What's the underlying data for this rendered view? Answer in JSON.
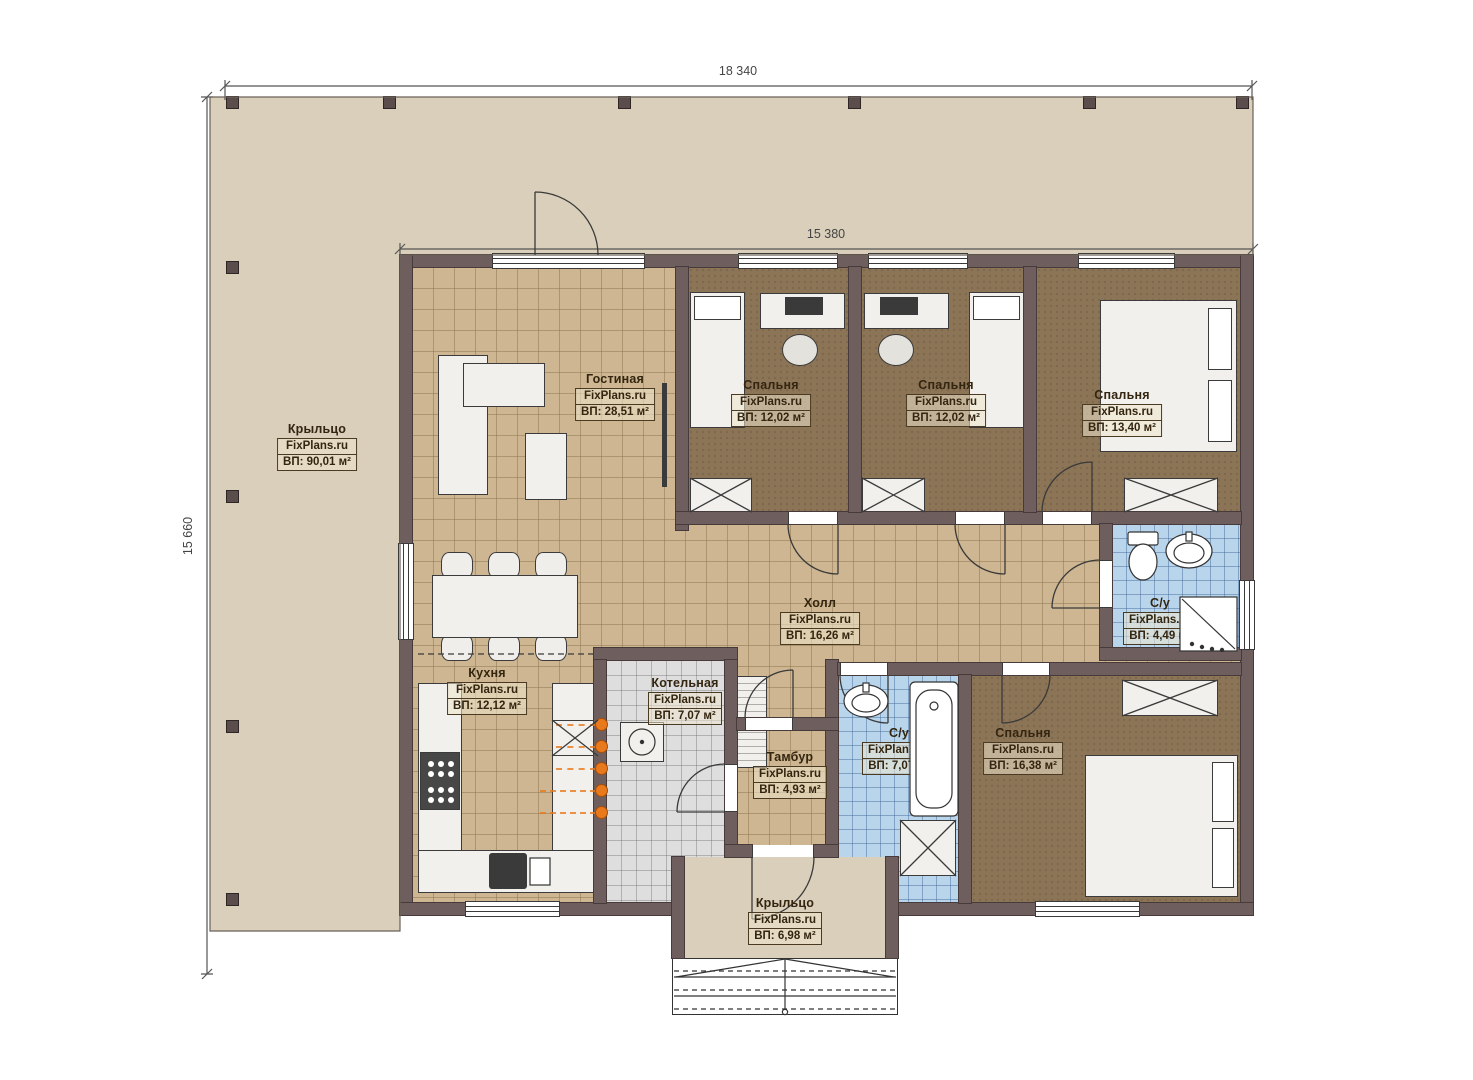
{
  "watermark": "FixPlans.ru",
  "dimensions": {
    "overall_width": "18 340",
    "house_width": "15 380",
    "overall_height": "15 660"
  },
  "rooms": [
    {
      "key": "porch-left",
      "name": "Крыльцо",
      "area": "ВП: 90,01 м²"
    },
    {
      "key": "living-room",
      "name": "Гостиная",
      "area": "ВП: 28,51 м²"
    },
    {
      "key": "bedroom-1",
      "name": "Спальня",
      "area": "ВП: 12,02 м²"
    },
    {
      "key": "bedroom-2",
      "name": "Спальня",
      "area": "ВП: 12,02 м²"
    },
    {
      "key": "bedroom-3",
      "name": "Спальня",
      "area": "ВП: 13,40 м²"
    },
    {
      "key": "hall",
      "name": "Холл",
      "area": "ВП: 16,26 м²"
    },
    {
      "key": "bathroom-top",
      "name": "С/у",
      "area": "ВП: 4,49 м²"
    },
    {
      "key": "kitchen",
      "name": "Кухня",
      "area": "ВП: 12,12 м²"
    },
    {
      "key": "boiler-room",
      "name": "Котельная",
      "area": "ВП: 7,07 м²"
    },
    {
      "key": "vestibule",
      "name": "Тамбур",
      "area": "ВП: 4,93 м²"
    },
    {
      "key": "bathroom-bottom",
      "name": "С/у",
      "area": "ВП: 7,07 м²"
    },
    {
      "key": "bedroom-4",
      "name": "Спальня",
      "area": "ВП: 16,38 м²"
    },
    {
      "key": "porch-bottom",
      "name": "Крыльцо",
      "area": "ВП: 6,98 м²"
    }
  ],
  "colors": {
    "porch": "#d9cfba",
    "floor_tile": "#cdb691",
    "carpet": "#8c7457",
    "bathroom_tile": "#b9d5eb",
    "boiler_tile": "#dedede",
    "wall": "#6e5e5e",
    "utility_marker": "#e8791c"
  }
}
